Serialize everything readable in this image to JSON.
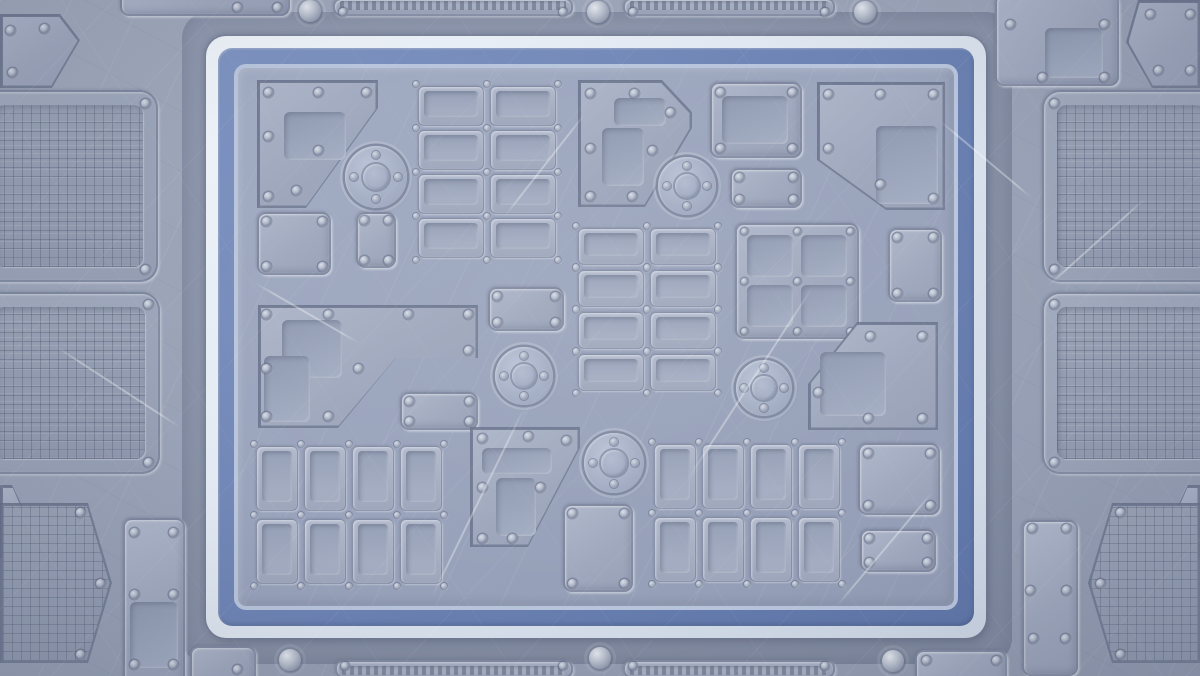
{
  "scene": {
    "label": "sci-fi metal plate arena background",
    "width": 1200,
    "height": 676
  },
  "palette": {
    "base": "#99a2b6",
    "shadow_band": "#8a93a8",
    "frame_white": "#e3eaf2",
    "frame_blue": "#6c83b3",
    "frame_inner_line": "#b8c5dc",
    "field": "#9aa4bc",
    "panel": "#a5aec2",
    "panel_edge": "#6f7994",
    "recess": "#939db3",
    "rivet_light": "#d9dee7",
    "rivet_dark": "#828ca4",
    "mesh_line": "#4c5c78",
    "slat_dark": "#7b8499",
    "slat_light": "#aab2c5"
  },
  "frame": {
    "band": [
      182,
      12,
      830,
      652,
      26
    ],
    "white": [
      206,
      36,
      780,
      602,
      20
    ],
    "blue": [
      218,
      48,
      756,
      578,
      14
    ],
    "field": [
      234,
      64,
      724,
      546,
      12
    ]
  },
  "field_elements": [
    {
      "type": "poly",
      "name": "panel-top-left-chamfered",
      "points": [
        [
          257,
          80
        ],
        [
          378,
          80
        ],
        [
          378,
          108
        ],
        [
          306,
          208
        ],
        [
          257,
          208
        ]
      ],
      "rivets": [
        [
          268,
          92
        ],
        [
          318,
          92
        ],
        [
          366,
          92
        ],
        [
          268,
          136
        ],
        [
          268,
          196
        ],
        [
          318,
          150
        ],
        [
          296,
          190
        ]
      ],
      "recesses": [
        [
          284,
          112,
          62,
          48
        ]
      ]
    },
    {
      "type": "grid",
      "name": "plate-grid-top",
      "x": 418,
      "y": 86,
      "cols": 2,
      "rows": 4,
      "cw": 66,
      "ch": 40,
      "gx": 6,
      "gy": 4
    },
    {
      "type": "port",
      "name": "port-top-left",
      "x": 376,
      "y": 177,
      "r": 31
    },
    {
      "type": "panel",
      "name": "panel-small-square-left",
      "x": 257,
      "y": 212,
      "w": 74,
      "h": 63,
      "rivets": [
        [
          266,
          221
        ],
        [
          322,
          221
        ],
        [
          266,
          266
        ],
        [
          322,
          266
        ]
      ]
    },
    {
      "type": "panel",
      "name": "plate-small-vertical-left",
      "x": 356,
      "y": 212,
      "w": 40,
      "h": 56,
      "rivets": [
        [
          364,
          220
        ],
        [
          388,
          220
        ],
        [
          364,
          260
        ],
        [
          388,
          260
        ]
      ]
    },
    {
      "type": "poly",
      "name": "panel-seven-shape-top",
      "points": [
        [
          578,
          80
        ],
        [
          662,
          80
        ],
        [
          692,
          112
        ],
        [
          692,
          128
        ],
        [
          645,
          207
        ],
        [
          578,
          207
        ]
      ],
      "rivets": [
        [
          590,
          93
        ],
        [
          634,
          93
        ],
        [
          670,
          112
        ],
        [
          590,
          148
        ],
        [
          590,
          196
        ],
        [
          632,
          196
        ],
        [
          652,
          150
        ]
      ],
      "recesses": [
        [
          614,
          98,
          52,
          28
        ],
        [
          602,
          128,
          42,
          58
        ]
      ]
    },
    {
      "type": "port",
      "name": "port-top-center",
      "x": 687,
      "y": 186,
      "r": 29
    },
    {
      "type": "panel",
      "name": "panel-square-top-center",
      "x": 710,
      "y": 82,
      "w": 92,
      "h": 76,
      "rivets": [
        [
          720,
          92
        ],
        [
          792,
          92
        ],
        [
          720,
          148
        ],
        [
          792,
          148
        ]
      ],
      "recesses": [
        [
          722,
          96,
          66,
          48
        ]
      ]
    },
    {
      "type": "poly",
      "name": "panel-top-right-large",
      "points": [
        [
          817,
          82
        ],
        [
          945,
          82
        ],
        [
          945,
          210
        ],
        [
          886,
          210
        ],
        [
          817,
          160
        ]
      ],
      "rivets": [
        [
          828,
          94
        ],
        [
          880,
          94
        ],
        [
          933,
          94
        ],
        [
          828,
          148
        ],
        [
          880,
          184
        ],
        [
          933,
          198
        ]
      ],
      "recesses": [
        [
          876,
          126,
          62,
          78
        ]
      ]
    },
    {
      "type": "panel",
      "name": "plate-small-horizontal-center",
      "x": 730,
      "y": 168,
      "w": 72,
      "h": 40,
      "rivets": [
        [
          739,
          177
        ],
        [
          793,
          177
        ],
        [
          739,
          199
        ],
        [
          793,
          199
        ]
      ]
    },
    {
      "type": "grid",
      "name": "plate-grid-center",
      "x": 578,
      "y": 228,
      "cols": 2,
      "rows": 4,
      "cw": 66,
      "ch": 37,
      "gx": 6,
      "gy": 5
    },
    {
      "type": "panel",
      "name": "plate-center-left",
      "x": 488,
      "y": 287,
      "w": 76,
      "h": 44,
      "rivets": [
        [
          497,
          296
        ],
        [
          555,
          296
        ],
        [
          497,
          322
        ],
        [
          555,
          322
        ]
      ]
    },
    {
      "type": "squareGrid",
      "name": "panel-window-grid",
      "x": 735,
      "y": 223,
      "w": 124,
      "h": 116
    },
    {
      "type": "panel",
      "name": "plate-right-vertical",
      "x": 888,
      "y": 228,
      "w": 54,
      "h": 74,
      "rivets": [
        [
          897,
          237
        ],
        [
          933,
          237
        ],
        [
          897,
          293
        ],
        [
          933,
          293
        ]
      ]
    },
    {
      "type": "poly",
      "name": "panel-mid-left-large",
      "points": [
        [
          258,
          305
        ],
        [
          478,
          305
        ],
        [
          478,
          358
        ],
        [
          396,
          358
        ],
        [
          338,
          428
        ],
        [
          258,
          428
        ]
      ],
      "rivets": [
        [
          266,
          314
        ],
        [
          328,
          314
        ],
        [
          408,
          314
        ],
        [
          468,
          314
        ],
        [
          266,
          368
        ],
        [
          358,
          368
        ],
        [
          266,
          416
        ],
        [
          328,
          416
        ],
        [
          468,
          350
        ]
      ],
      "recesses": [
        [
          282,
          320,
          60,
          58
        ],
        [
          264,
          356,
          46,
          66
        ]
      ]
    },
    {
      "type": "panel",
      "name": "plate-mid-small",
      "x": 400,
      "y": 392,
      "w": 78,
      "h": 38,
      "rivets": [
        [
          409,
          401
        ],
        [
          469,
          401
        ],
        [
          409,
          421
        ],
        [
          469,
          421
        ]
      ]
    },
    {
      "type": "port",
      "name": "port-mid-left",
      "x": 524,
      "y": 376,
      "r": 29
    },
    {
      "type": "poly",
      "name": "panel-bottom-chamfered",
      "points": [
        [
          470,
          427
        ],
        [
          580,
          427
        ],
        [
          580,
          448
        ],
        [
          528,
          547
        ],
        [
          470,
          547
        ]
      ],
      "rivets": [
        [
          482,
          438
        ],
        [
          528,
          436
        ],
        [
          566,
          440
        ],
        [
          482,
          487
        ],
        [
          540,
          487
        ],
        [
          482,
          538
        ],
        [
          512,
          538
        ]
      ],
      "recesses": [
        [
          482,
          448,
          70,
          26
        ],
        [
          496,
          478,
          40,
          58
        ]
      ]
    },
    {
      "type": "port",
      "name": "port-bottom-center",
      "x": 614,
      "y": 463,
      "r": 30
    },
    {
      "type": "panel",
      "name": "plate-bottom-center",
      "x": 563,
      "y": 504,
      "w": 70,
      "h": 88,
      "rivets": [
        [
          572,
          513
        ],
        [
          624,
          513
        ],
        [
          572,
          583
        ],
        [
          624,
          583
        ]
      ]
    },
    {
      "type": "grid",
      "name": "plate-grid-bottom-left",
      "x": 256,
      "y": 446,
      "cols": 4,
      "rows": 2,
      "cw": 42,
      "ch": 65,
      "gx": 6,
      "gy": 8
    },
    {
      "type": "grid",
      "name": "plate-grid-bottom-right",
      "x": 654,
      "y": 444,
      "cols": 4,
      "rows": 2,
      "cw": 42,
      "ch": 65,
      "gx": 6,
      "gy": 8
    },
    {
      "type": "panel",
      "name": "plate-bottom-right-square",
      "x": 858,
      "y": 443,
      "w": 82,
      "h": 72,
      "rivets": [
        [
          868,
          453
        ],
        [
          930,
          453
        ],
        [
          868,
          505
        ],
        [
          930,
          505
        ]
      ]
    },
    {
      "type": "panel",
      "name": "plate-bottom-right-small",
      "x": 860,
      "y": 529,
      "w": 76,
      "h": 43,
      "rivets": [
        [
          869,
          538
        ],
        [
          927,
          538
        ],
        [
          869,
          562
        ],
        [
          927,
          562
        ]
      ]
    },
    {
      "type": "poly",
      "name": "panel-right-trapezoid",
      "points": [
        [
          857,
          322
        ],
        [
          938,
          322
        ],
        [
          938,
          430
        ],
        [
          808,
          430
        ],
        [
          808,
          384
        ]
      ],
      "rivets": [
        [
          870,
          336
        ],
        [
          922,
          336
        ],
        [
          818,
          392
        ],
        [
          868,
          418
        ],
        [
          922,
          418
        ]
      ],
      "recesses": [
        [
          820,
          352,
          66,
          64
        ]
      ]
    },
    {
      "type": "port",
      "name": "port-mid-right",
      "x": 764,
      "y": 388,
      "r": 28
    }
  ],
  "outer_elements": [
    {
      "type": "poly",
      "name": "corner-panel-top-left",
      "points": [
        [
          0,
          14
        ],
        [
          60,
          14
        ],
        [
          80,
          40
        ],
        [
          52,
          88
        ],
        [
          0,
          88
        ]
      ],
      "rivets": [
        [
          10,
          30
        ],
        [
          44,
          28
        ],
        [
          12,
          72
        ]
      ]
    },
    {
      "type": "mesh",
      "name": "mesh-panel-left-top",
      "x": -20,
      "y": 90,
      "w": 178,
      "h": 192,
      "corner": "right",
      "rivets": [
        [
          145,
          103
        ],
        [
          145,
          269
        ]
      ]
    },
    {
      "type": "mesh",
      "name": "mesh-panel-left-bottom",
      "x": -20,
      "y": 292,
      "w": 180,
      "h": 182,
      "corner": "right",
      "rivets": [
        [
          148,
          304
        ],
        [
          148,
          462
        ]
      ]
    },
    {
      "type": "poly",
      "name": "chevron-left",
      "points": [
        [
          0,
          485
        ],
        [
          12,
          485
        ],
        [
          30,
          522
        ],
        [
          12,
          558
        ],
        [
          0,
          558
        ]
      ]
    },
    {
      "type": "poly",
      "name": "hex-mesh-bottom-left",
      "mesh": true,
      "points": [
        [
          0,
          503
        ],
        [
          88,
          503
        ],
        [
          112,
          583
        ],
        [
          88,
          663
        ],
        [
          0,
          663
        ]
      ],
      "rivets": [
        [
          80,
          512
        ],
        [
          100,
          583
        ],
        [
          80,
          654
        ]
      ]
    },
    {
      "type": "panel",
      "name": "panel-bottom-left-vertical",
      "x": 123,
      "y": 518,
      "w": 62,
      "h": 170,
      "rivets": [
        [
          134,
          532
        ],
        [
          173,
          532
        ],
        [
          134,
          594
        ],
        [
          173,
          594
        ],
        [
          134,
          664
        ],
        [
          173,
          664
        ]
      ],
      "recesses": [
        [
          130,
          602,
          48,
          66
        ]
      ]
    },
    {
      "type": "panel",
      "name": "panel-top-edge-left",
      "x": 120,
      "y": -12,
      "w": 170,
      "h": 28,
      "rivets": [
        [
          237,
          7
        ],
        [
          277,
          7
        ]
      ]
    },
    {
      "type": "panel",
      "name": "panel-top-right-outer",
      "x": 995,
      "y": -6,
      "w": 124,
      "h": 92,
      "rivets": [
        [
          1010,
          24
        ],
        [
          1104,
          24
        ],
        [
          1042,
          77
        ],
        [
          1104,
          77
        ]
      ],
      "recesses": [
        [
          1045,
          28,
          58,
          50
        ]
      ]
    },
    {
      "type": "poly",
      "name": "corner-panel-top-right",
      "points": [
        [
          1138,
          0
        ],
        [
          1200,
          0
        ],
        [
          1200,
          88
        ],
        [
          1152,
          88
        ],
        [
          1126,
          42
        ]
      ],
      "rivets": [
        [
          1150,
          14
        ],
        [
          1190,
          14
        ],
        [
          1158,
          70
        ],
        [
          1190,
          70
        ]
      ]
    },
    {
      "type": "mesh",
      "name": "mesh-panel-right-top",
      "x": 1042,
      "y": 90,
      "w": 178,
      "h": 192,
      "corner": "left",
      "rivets": [
        [
          1054,
          103
        ],
        [
          1054,
          269
        ]
      ]
    },
    {
      "type": "mesh",
      "name": "mesh-panel-right-bottom",
      "x": 1042,
      "y": 292,
      "w": 180,
      "h": 182,
      "corner": "left",
      "rivets": [
        [
          1054,
          304
        ],
        [
          1054,
          462
        ]
      ]
    },
    {
      "type": "poly",
      "name": "chevron-right",
      "points": [
        [
          1200,
          485
        ],
        [
          1188,
          485
        ],
        [
          1170,
          522
        ],
        [
          1188,
          558
        ],
        [
          1200,
          558
        ]
      ]
    },
    {
      "type": "poly",
      "name": "hex-mesh-bottom-right",
      "mesh": true,
      "points": [
        [
          1112,
          503
        ],
        [
          1200,
          503
        ],
        [
          1200,
          663
        ],
        [
          1112,
          663
        ],
        [
          1088,
          583
        ]
      ],
      "rivets": [
        [
          1120,
          512
        ],
        [
          1100,
          583
        ],
        [
          1120,
          654
        ]
      ]
    },
    {
      "type": "panel",
      "name": "panel-bottom-right-vertical",
      "x": 1022,
      "y": 520,
      "w": 56,
      "h": 156,
      "rivets": [
        [
          1032,
          528
        ],
        [
          1066,
          528
        ],
        [
          1030,
          590
        ],
        [
          1066,
          590
        ],
        [
          1033,
          638
        ],
        [
          1065,
          638
        ]
      ]
    },
    {
      "type": "panel",
      "name": "panel-bottom-edge-left",
      "x": 190,
      "y": 646,
      "w": 66,
      "h": 40,
      "rivets": [
        [
          237,
          669
        ]
      ]
    },
    {
      "type": "panel",
      "name": "panel-bottom-edge-right",
      "x": 915,
      "y": 650,
      "w": 92,
      "h": 36,
      "rivets": [
        [
          926,
          660
        ],
        [
          996,
          660
        ]
      ]
    }
  ],
  "vents": [
    {
      "name": "vent-top-left",
      "x": 333,
      "y": -2,
      "w": 240,
      "h": 18,
      "side": "top",
      "screws": [
        [
          343,
          12
        ],
        [
          563,
          12
        ]
      ]
    },
    {
      "name": "vent-top-right",
      "x": 623,
      "y": -2,
      "w": 212,
      "h": 18,
      "side": "top",
      "screws": [
        [
          633,
          12
        ],
        [
          825,
          12
        ]
      ]
    },
    {
      "name": "vent-bottom-left",
      "x": 335,
      "y": 660,
      "w": 238,
      "h": 18,
      "side": "bottom",
      "screws": [
        [
          345,
          666
        ],
        [
          563,
          666
        ]
      ]
    },
    {
      "name": "vent-bottom-right",
      "x": 623,
      "y": 660,
      "w": 212,
      "h": 18,
      "side": "bottom",
      "screws": [
        [
          633,
          666
        ],
        [
          825,
          666
        ]
      ]
    }
  ],
  "domes": [
    [
      310,
      11
    ],
    [
      598,
      12
    ],
    [
      865,
      12
    ],
    [
      290,
      660
    ],
    [
      600,
      658
    ],
    [
      893,
      661
    ]
  ],
  "scratches": [
    {
      "x": 432,
      "y": 596,
      "len": 210,
      "ang": -64
    },
    {
      "x": 505,
      "y": 215,
      "len": 130,
      "ang": -52
    },
    {
      "x": 688,
      "y": 478,
      "len": 230,
      "ang": -57
    },
    {
      "x": 255,
      "y": 282,
      "len": 120,
      "ang": 30
    },
    {
      "x": 55,
      "y": 345,
      "len": 150,
      "ang": 33
    },
    {
      "x": 1048,
      "y": 285,
      "len": 130,
      "ang": -42
    },
    {
      "x": 836,
      "y": 606,
      "len": 150,
      "ang": -50
    },
    {
      "x": 940,
      "y": 120,
      "len": 120,
      "ang": 40
    }
  ]
}
